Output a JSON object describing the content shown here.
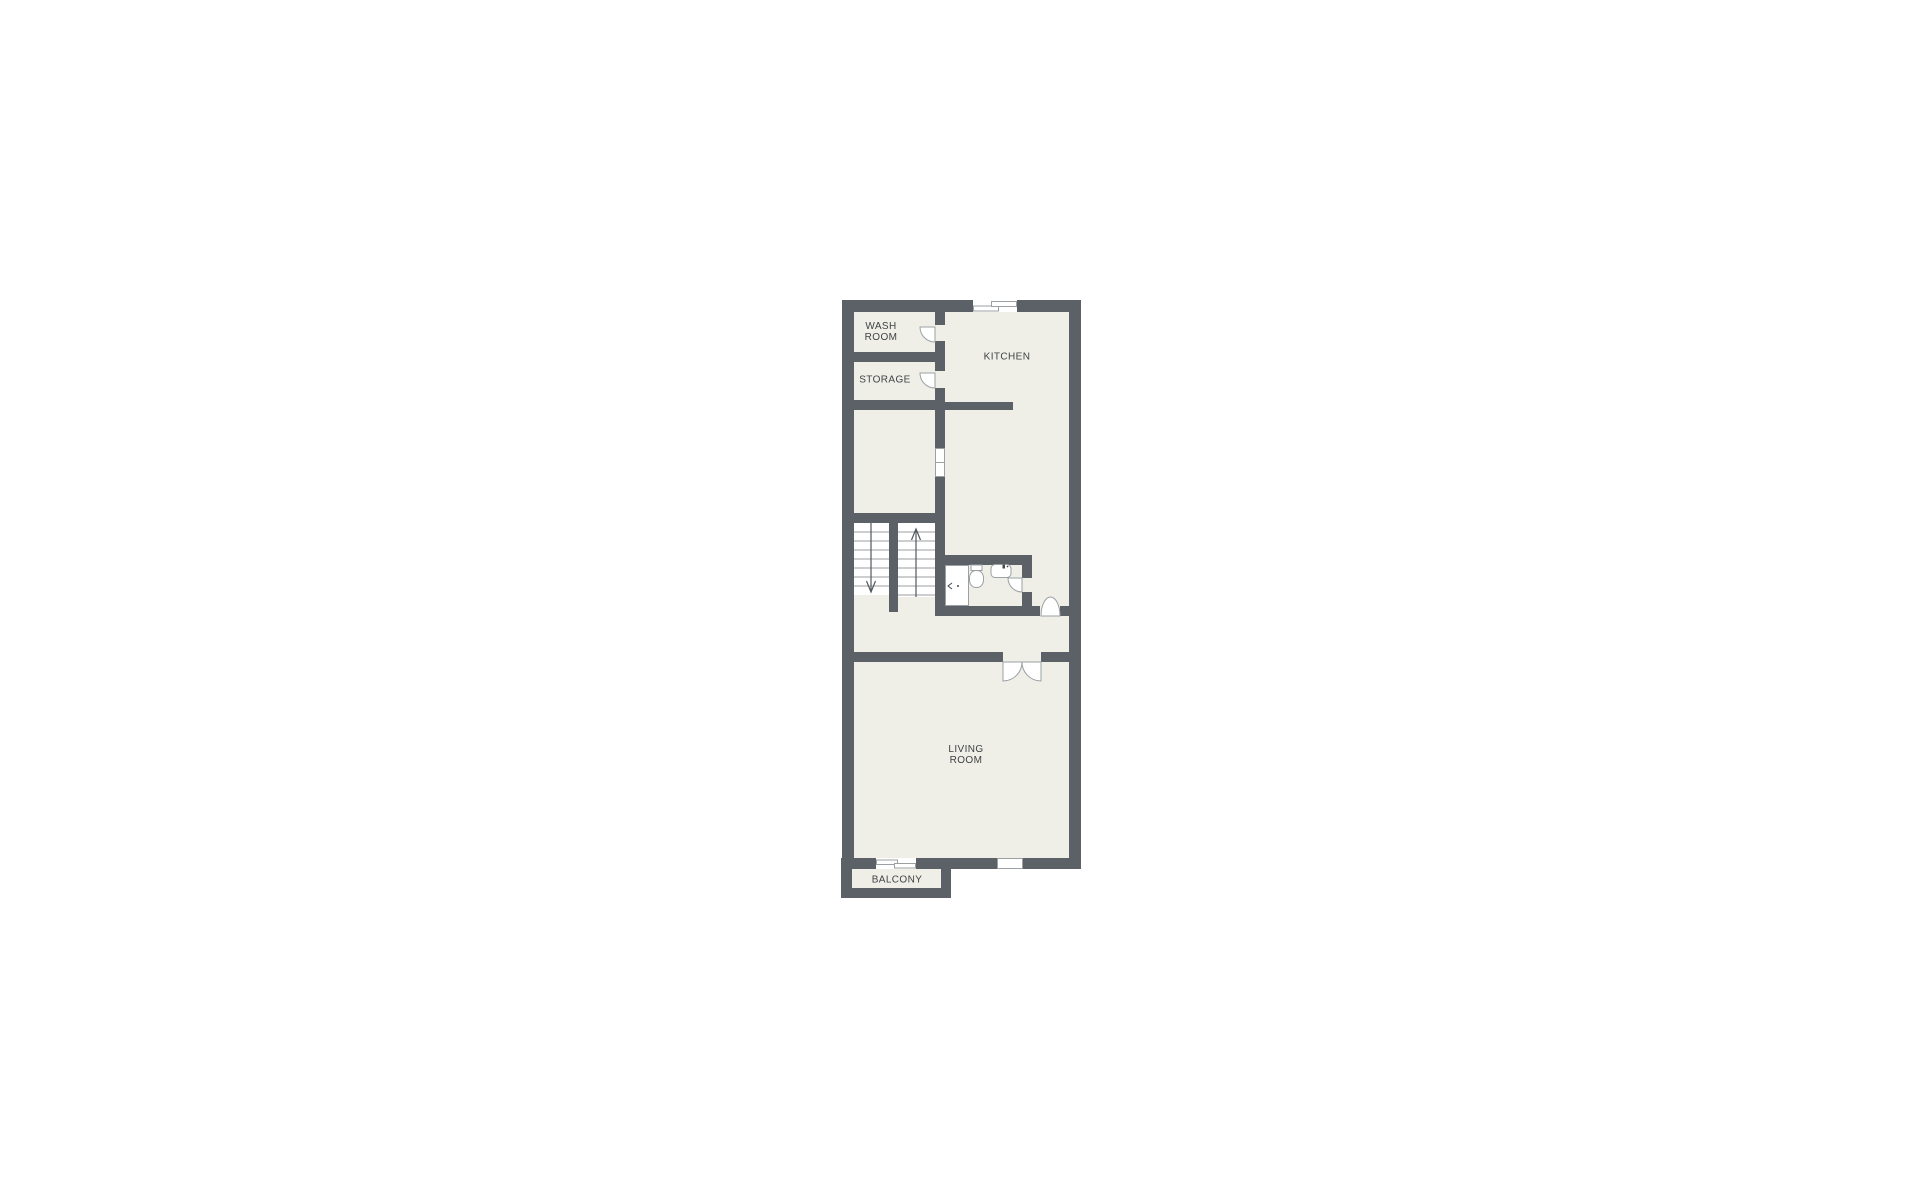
{
  "plan": {
    "rooms": {
      "wash_room": {
        "lines": [
          "WASH",
          "ROOM"
        ]
      },
      "storage": {
        "lines": [
          "STORAGE"
        ]
      },
      "kitchen": {
        "lines": [
          "KITCHEN"
        ]
      },
      "living_room": {
        "lines": [
          "LIVING",
          "ROOM"
        ]
      },
      "balcony": {
        "lines": [
          "BALCONY"
        ]
      }
    },
    "colors": {
      "background": "#ffffff",
      "wall": "#5b6167",
      "floor": "#efefe8",
      "symbol_stroke": "#9aa0a3",
      "tread_stroke": "#9a9da0",
      "arrow": "#54585d",
      "label_text": "#3f4245"
    }
  }
}
